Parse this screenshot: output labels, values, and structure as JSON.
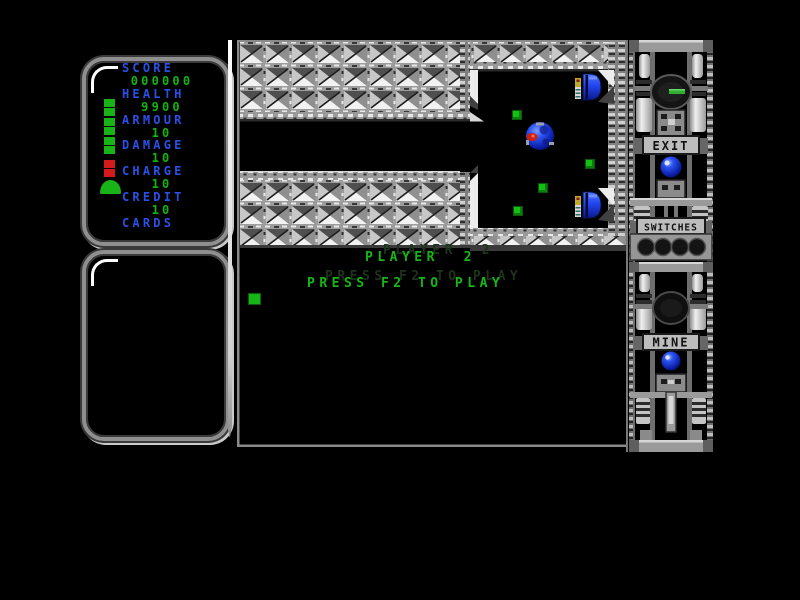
{
  "colors": {
    "label_blue": "#2b50e8",
    "value_green": "#12b412",
    "message_green": "#16b616",
    "ghost_green": "#1d331d",
    "pickup_green": "#15c015",
    "health_green": "#19b219",
    "health_red": "#d41a1a",
    "orb_blue": "#2a52f0",
    "ship_blue": "#2244ee",
    "ball_red": "#cc2012"
  },
  "stats_panel": {
    "rows": [
      {
        "label": "SCORE",
        "value": "000000"
      },
      {
        "label": "HEALTH",
        "value": "9900"
      },
      {
        "label": "ARMOUR",
        "value": "10"
      },
      {
        "label": "DAMAGE",
        "value": "10"
      },
      {
        "label": "CHARGE",
        "value": "10"
      },
      {
        "label": "CREDIT",
        "value": "10"
      },
      {
        "label": "CARDS",
        "value": ""
      }
    ],
    "thermometer": {
      "green_segments": 6,
      "red_segments": 2
    }
  },
  "messages": {
    "player_line": "PLAYER  2",
    "prompt_line": "PRESS F2 TO PLAY"
  },
  "right_panel": {
    "exit_label": "EXIT",
    "switches_label": "SWITCHES",
    "mine_label": "MINE",
    "switch_count": 4
  },
  "game": {
    "pickups": [
      {
        "x": 275,
        "y": 70
      },
      {
        "x": 348,
        "y": 119
      },
      {
        "x": 301,
        "y": 143
      },
      {
        "x": 276,
        "y": 166
      }
    ],
    "ball": {
      "x": 303,
      "y": 96
    },
    "docked_ships": 2
  }
}
